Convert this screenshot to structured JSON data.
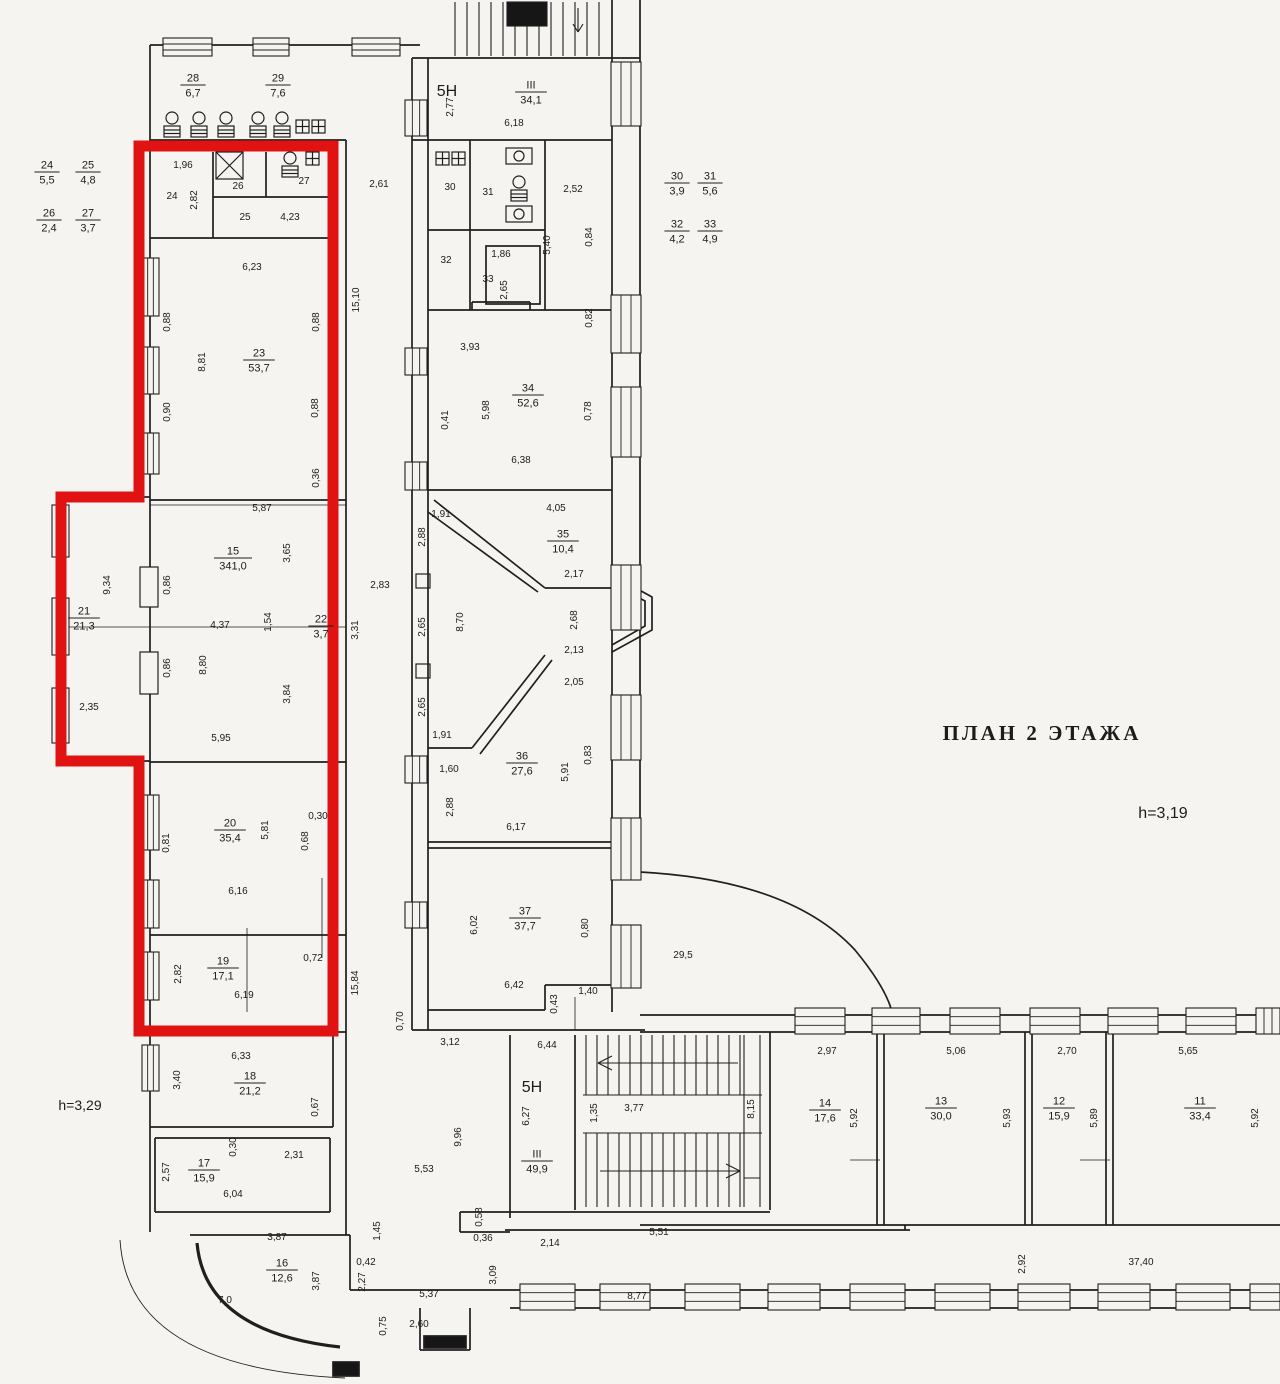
{
  "title": {
    "text": "ПЛАН 2 ЭТАЖА"
  },
  "notes": {
    "h_right": "h=3,19",
    "h_left": "h=3,29",
    "zone_top": "5Н",
    "zone_bottom": "5Н"
  },
  "colors": {
    "highlight": "#e01212",
    "ink": "#1f1f1f",
    "paper": "#f5f4f0"
  },
  "rooms": [
    {
      "n": "28",
      "a": "6,7",
      "x": 193,
      "y": 85
    },
    {
      "n": "29",
      "a": "7,6",
      "x": 278,
      "y": 85
    },
    {
      "n": "24",
      "a": "5,5",
      "x": 47,
      "y": 172
    },
    {
      "n": "25",
      "a": "4,8",
      "x": 88,
      "y": 172
    },
    {
      "n": "26",
      "a": "2,4",
      "x": 49,
      "y": 220
    },
    {
      "n": "27",
      "a": "3,7",
      "x": 88,
      "y": 220
    },
    {
      "n": "III",
      "a": "34,1",
      "x": 531,
      "y": 92
    },
    {
      "n": "30",
      "a": "3,9",
      "x": 677,
      "y": 183
    },
    {
      "n": "31",
      "a": "5,6",
      "x": 710,
      "y": 183
    },
    {
      "n": "32",
      "a": "4,2",
      "x": 677,
      "y": 231
    },
    {
      "n": "33",
      "a": "4,9",
      "x": 710,
      "y": 231
    },
    {
      "n": "23",
      "a": "53,7",
      "x": 259,
      "y": 360
    },
    {
      "n": "34",
      "a": "52,6",
      "x": 528,
      "y": 395
    },
    {
      "n": "15",
      "a": "341,0",
      "x": 233,
      "y": 558
    },
    {
      "n": "21",
      "a": "21,3",
      "x": 84,
      "y": 618
    },
    {
      "n": "22",
      "a": "3,7",
      "x": 321,
      "y": 626
    },
    {
      "n": "35",
      "a": "10,4",
      "x": 563,
      "y": 541
    },
    {
      "n": "36",
      "a": "27,6",
      "x": 522,
      "y": 763
    },
    {
      "n": "20",
      "a": "35,4",
      "x": 230,
      "y": 830
    },
    {
      "n": "37",
      "a": "37,7",
      "x": 525,
      "y": 918
    },
    {
      "n": "19",
      "a": "17,1",
      "x": 223,
      "y": 968
    },
    {
      "n": "18",
      "a": "21,2",
      "x": 250,
      "y": 1083
    },
    {
      "n": "17",
      "a": "15,9",
      "x": 204,
      "y": 1170
    },
    {
      "n": "16",
      "a": "12,6",
      "x": 282,
      "y": 1270
    },
    {
      "n": "III",
      "a": "49,9",
      "x": 537,
      "y": 1161
    },
    {
      "n": "14",
      "a": "17,6",
      "x": 825,
      "y": 1110
    },
    {
      "n": "13",
      "a": "30,0",
      "x": 941,
      "y": 1108
    },
    {
      "n": "12",
      "a": "15,9",
      "x": 1059,
      "y": 1108
    },
    {
      "n": "11",
      "a": "33,4",
      "x": 1200,
      "y": 1108
    }
  ],
  "dims": [
    {
      "t": "1,96",
      "x": 183,
      "y": 168,
      "r": 0
    },
    {
      "t": "24",
      "x": 172,
      "y": 199,
      "r": 0
    },
    {
      "t": "2,82",
      "x": 197,
      "y": 200,
      "r": 1
    },
    {
      "t": "26",
      "x": 238,
      "y": 189,
      "r": 0
    },
    {
      "t": "27",
      "x": 304,
      "y": 184,
      "r": 0
    },
    {
      "t": "25",
      "x": 245,
      "y": 220,
      "r": 0
    },
    {
      "t": "4,23",
      "x": 290,
      "y": 220,
      "r": 0
    },
    {
      "t": "2,61",
      "x": 379,
      "y": 187,
      "r": 0
    },
    {
      "t": "2,77",
      "x": 453,
      "y": 107,
      "r": 1
    },
    {
      "t": "6,18",
      "x": 514,
      "y": 126,
      "r": 0
    },
    {
      "t": "30",
      "x": 450,
      "y": 190,
      "r": 0
    },
    {
      "t": "31",
      "x": 488,
      "y": 195,
      "r": 0
    },
    {
      "t": "2,52",
      "x": 573,
      "y": 192,
      "r": 0
    },
    {
      "t": "5,40",
      "x": 550,
      "y": 245,
      "r": 1
    },
    {
      "t": "0,84",
      "x": 592,
      "y": 237,
      "r": 1
    },
    {
      "t": "32",
      "x": 446,
      "y": 263,
      "r": 0
    },
    {
      "t": "1,86",
      "x": 501,
      "y": 257,
      "r": 0
    },
    {
      "t": "33",
      "x": 488,
      "y": 282,
      "r": 0
    },
    {
      "t": "2,65",
      "x": 507,
      "y": 290,
      "r": 1
    },
    {
      "t": "6,23",
      "x": 252,
      "y": 270,
      "r": 0
    },
    {
      "t": "0,88",
      "x": 170,
      "y": 322,
      "r": 1
    },
    {
      "t": "0,88",
      "x": 319,
      "y": 322,
      "r": 1
    },
    {
      "t": "8,81",
      "x": 205,
      "y": 362,
      "r": 1
    },
    {
      "t": "15,10",
      "x": 359,
      "y": 300,
      "r": 1
    },
    {
      "t": "0,90",
      "x": 170,
      "y": 412,
      "r": 1
    },
    {
      "t": "0,88",
      "x": 318,
      "y": 408,
      "r": 1
    },
    {
      "t": "0,36",
      "x": 319,
      "y": 478,
      "r": 1
    },
    {
      "t": "3,93",
      "x": 470,
      "y": 350,
      "r": 0
    },
    {
      "t": "0,41",
      "x": 448,
      "y": 420,
      "r": 1
    },
    {
      "t": "5,98",
      "x": 489,
      "y": 410,
      "r": 1
    },
    {
      "t": "0,82",
      "x": 592,
      "y": 318,
      "r": 1
    },
    {
      "t": "0,78",
      "x": 591,
      "y": 411,
      "r": 1
    },
    {
      "t": "6,38",
      "x": 521,
      "y": 463,
      "r": 0
    },
    {
      "t": "1,91",
      "x": 441,
      "y": 517,
      "r": 0
    },
    {
      "t": "4,05",
      "x": 556,
      "y": 511,
      "r": 0
    },
    {
      "t": "5,87",
      "x": 262,
      "y": 511,
      "r": 0
    },
    {
      "t": "3,65",
      "x": 290,
      "y": 553,
      "r": 1
    },
    {
      "t": "9,34",
      "x": 110,
      "y": 585,
      "r": 1
    },
    {
      "t": "0,86",
      "x": 170,
      "y": 585,
      "r": 1
    },
    {
      "t": "4,37",
      "x": 220,
      "y": 628,
      "r": 0
    },
    {
      "t": "1,54",
      "x": 271,
      "y": 622,
      "r": 1
    },
    {
      "t": "3,31",
      "x": 358,
      "y": 630,
      "r": 1
    },
    {
      "t": "2,83",
      "x": 380,
      "y": 588,
      "r": 0
    },
    {
      "t": "0,86",
      "x": 170,
      "y": 668,
      "r": 1
    },
    {
      "t": "8,80",
      "x": 206,
      "y": 665,
      "r": 1
    },
    {
      "t": "2,35",
      "x": 89,
      "y": 710,
      "r": 0
    },
    {
      "t": "3,84",
      "x": 290,
      "y": 694,
      "r": 1
    },
    {
      "t": "5,95",
      "x": 221,
      "y": 741,
      "r": 0
    },
    {
      "t": "2,88",
      "x": 425,
      "y": 537,
      "r": 1
    },
    {
      "t": "2,17",
      "x": 574,
      "y": 577,
      "r": 0
    },
    {
      "t": "2,65",
      "x": 425,
      "y": 627,
      "r": 1
    },
    {
      "t": "8,70",
      "x": 463,
      "y": 622,
      "r": 1
    },
    {
      "t": "2,68",
      "x": 577,
      "y": 620,
      "r": 1
    },
    {
      "t": "2,13",
      "x": 574,
      "y": 653,
      "r": 0
    },
    {
      "t": "2,05",
      "x": 574,
      "y": 685,
      "r": 0
    },
    {
      "t": "2,65",
      "x": 425,
      "y": 707,
      "r": 1
    },
    {
      "t": "1,91",
      "x": 442,
      "y": 738,
      "r": 0
    },
    {
      "t": "1,60",
      "x": 449,
      "y": 772,
      "r": 0
    },
    {
      "t": "2,88",
      "x": 453,
      "y": 807,
      "r": 1
    },
    {
      "t": "5,91",
      "x": 568,
      "y": 772,
      "r": 1
    },
    {
      "t": "0,83",
      "x": 591,
      "y": 755,
      "r": 1
    },
    {
      "t": "6,17",
      "x": 516,
      "y": 830,
      "r": 0
    },
    {
      "t": "0,30",
      "x": 318,
      "y": 819,
      "r": 0
    },
    {
      "t": "0,81",
      "x": 169,
      "y": 843,
      "r": 1
    },
    {
      "t": "5,81",
      "x": 268,
      "y": 830,
      "r": 1
    },
    {
      "t": "0,68",
      "x": 308,
      "y": 841,
      "r": 1
    },
    {
      "t": "6,16",
      "x": 238,
      "y": 894,
      "r": 0
    },
    {
      "t": "2,82",
      "x": 181,
      "y": 974,
      "r": 1
    },
    {
      "t": "0,72",
      "x": 313,
      "y": 961,
      "r": 0
    },
    {
      "t": "6,19",
      "x": 244,
      "y": 998,
      "r": 0
    },
    {
      "t": "15,84",
      "x": 358,
      "y": 983,
      "r": 1
    },
    {
      "t": "6,02",
      "x": 477,
      "y": 925,
      "r": 1
    },
    {
      "t": "0,80",
      "x": 588,
      "y": 928,
      "r": 1
    },
    {
      "t": "29,5",
      "x": 683,
      "y": 958,
      "r": 0
    },
    {
      "t": "6,42",
      "x": 514,
      "y": 988,
      "r": 0
    },
    {
      "t": "0,43",
      "x": 557,
      "y": 1004,
      "r": 1
    },
    {
      "t": "1,40",
      "x": 588,
      "y": 994,
      "r": 0
    },
    {
      "t": "0,70",
      "x": 403,
      "y": 1021,
      "r": 1
    },
    {
      "t": "6,33",
      "x": 241,
      "y": 1059,
      "r": 0
    },
    {
      "t": "3,40",
      "x": 180,
      "y": 1080,
      "r": 1
    },
    {
      "t": "0,67",
      "x": 318,
      "y": 1107,
      "r": 1
    },
    {
      "t": "0,30",
      "x": 236,
      "y": 1147,
      "r": 1
    },
    {
      "t": "2,31",
      "x": 294,
      "y": 1158,
      "r": 0
    },
    {
      "t": "2,57",
      "x": 169,
      "y": 1172,
      "r": 1
    },
    {
      "t": "6,04",
      "x": 233,
      "y": 1197,
      "r": 0
    },
    {
      "t": "3,87",
      "x": 277,
      "y": 1240,
      "r": 0
    },
    {
      "t": "3,87",
      "x": 319,
      "y": 1281,
      "r": 1
    },
    {
      "t": "7,0",
      "x": 225,
      "y": 1303,
      "r": 0
    },
    {
      "t": "1,45",
      "x": 380,
      "y": 1231,
      "r": 1
    },
    {
      "t": "0,42",
      "x": 366,
      "y": 1265,
      "r": 0
    },
    {
      "t": "2,27",
      "x": 365,
      "y": 1282,
      "r": 1
    },
    {
      "t": "0,75",
      "x": 386,
      "y": 1326,
      "r": 1
    },
    {
      "t": "2,60",
      "x": 419,
      "y": 1327,
      "r": 0
    },
    {
      "t": "5,37",
      "x": 429,
      "y": 1297,
      "r": 0
    },
    {
      "t": "3,12",
      "x": 450,
      "y": 1045,
      "r": 0
    },
    {
      "t": "5,53",
      "x": 424,
      "y": 1172,
      "r": 0
    },
    {
      "t": "9,96",
      "x": 461,
      "y": 1137,
      "r": 1
    },
    {
      "t": "6,44",
      "x": 547,
      "y": 1048,
      "r": 0
    },
    {
      "t": "6,27",
      "x": 529,
      "y": 1116,
      "r": 1
    },
    {
      "t": "1,35",
      "x": 597,
      "y": 1113,
      "r": 1
    },
    {
      "t": "3,77",
      "x": 634,
      "y": 1111,
      "r": 0
    },
    {
      "t": "8,15",
      "x": 754,
      "y": 1109,
      "r": 1
    },
    {
      "t": "0,58",
      "x": 482,
      "y": 1217,
      "r": 1
    },
    {
      "t": "0,36",
      "x": 483,
      "y": 1241,
      "r": 0
    },
    {
      "t": "2,14",
      "x": 550,
      "y": 1246,
      "r": 0
    },
    {
      "t": "3,09",
      "x": 496,
      "y": 1275,
      "r": 1
    },
    {
      "t": "5,51",
      "x": 659,
      "y": 1235,
      "r": 0
    },
    {
      "t": "8,77",
      "x": 637,
      "y": 1299,
      "r": 0
    },
    {
      "t": "2,97",
      "x": 827,
      "y": 1054,
      "r": 0
    },
    {
      "t": "5,06",
      "x": 956,
      "y": 1054,
      "r": 0
    },
    {
      "t": "2,70",
      "x": 1067,
      "y": 1054,
      "r": 0
    },
    {
      "t": "5,65",
      "x": 1188,
      "y": 1054,
      "r": 0
    },
    {
      "t": "5,92",
      "x": 857,
      "y": 1118,
      "r": 1
    },
    {
      "t": "5,93",
      "x": 1010,
      "y": 1118,
      "r": 1
    },
    {
      "t": "5,89",
      "x": 1097,
      "y": 1118,
      "r": 1
    },
    {
      "t": "5,92",
      "x": 1258,
      "y": 1118,
      "r": 1
    },
    {
      "t": "2,92",
      "x": 1025,
      "y": 1264,
      "r": 1
    },
    {
      "t": "37,40",
      "x": 1141,
      "y": 1265,
      "r": 0
    }
  ]
}
